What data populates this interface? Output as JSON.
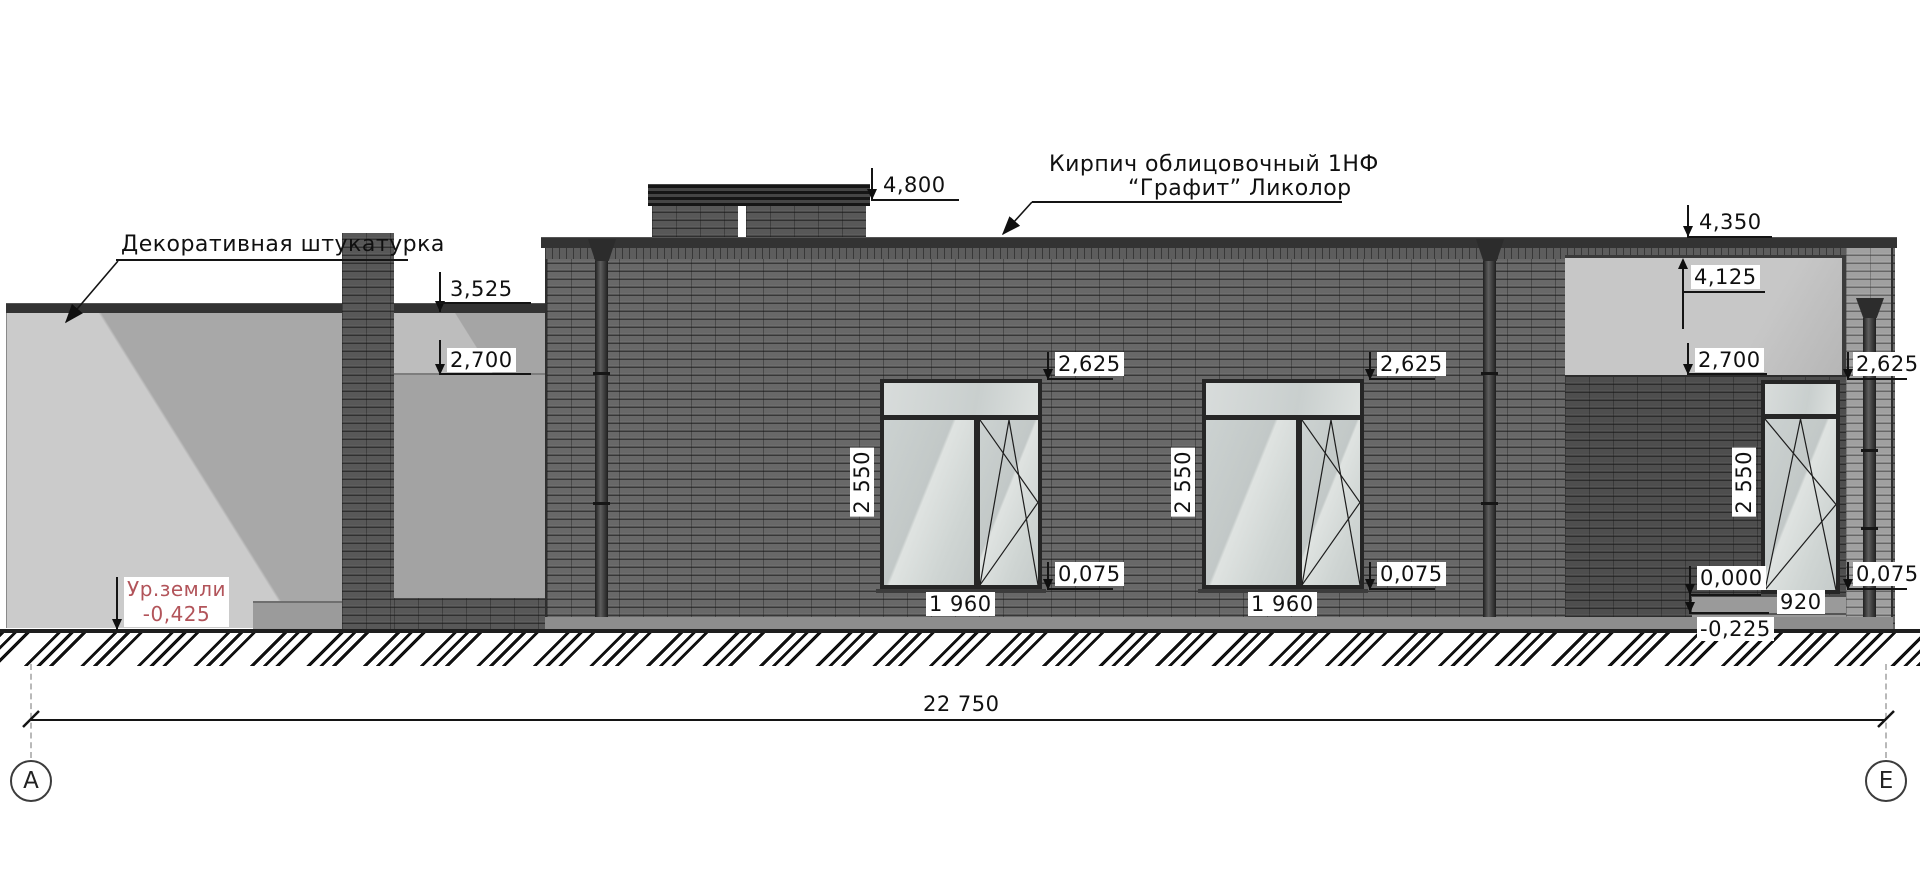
{
  "labels": {
    "plaster": "Декоративная штукатурка",
    "brick_line1": "Кирпич облицовочный 1НФ",
    "brick_line2": "“Графит” Ликолор",
    "ground_line1": "Ур.земли",
    "ground_line2": "-0,425"
  },
  "elevations": {
    "chimney_top": "4,800",
    "parapet": "4,350",
    "soffit": "4,125",
    "left_roof": "3,525",
    "left_recess_ceiling": "2,700",
    "porch_ceiling": "2,700",
    "window1_head": "2,625",
    "window2_head": "2,625",
    "door_head": "2,625",
    "window1_sill": "0,075",
    "window2_sill": "0,075",
    "right_plinth": "0,075",
    "porch_floor": "0,000",
    "step": "-0,225"
  },
  "dims": {
    "window1_h": "2 550",
    "window2_h": "2 550",
    "door_h": "2 550",
    "window1_w": "1 960",
    "window2_w": "1 960",
    "door_w": "920",
    "overall": "22 750"
  },
  "axes": {
    "left": "А",
    "right": "Е"
  },
  "colors": {
    "brick_dark": "#686868",
    "brick_light": "#a0a0a0",
    "plaster": "#c9c9c9",
    "ground_text": "#b2545a"
  }
}
